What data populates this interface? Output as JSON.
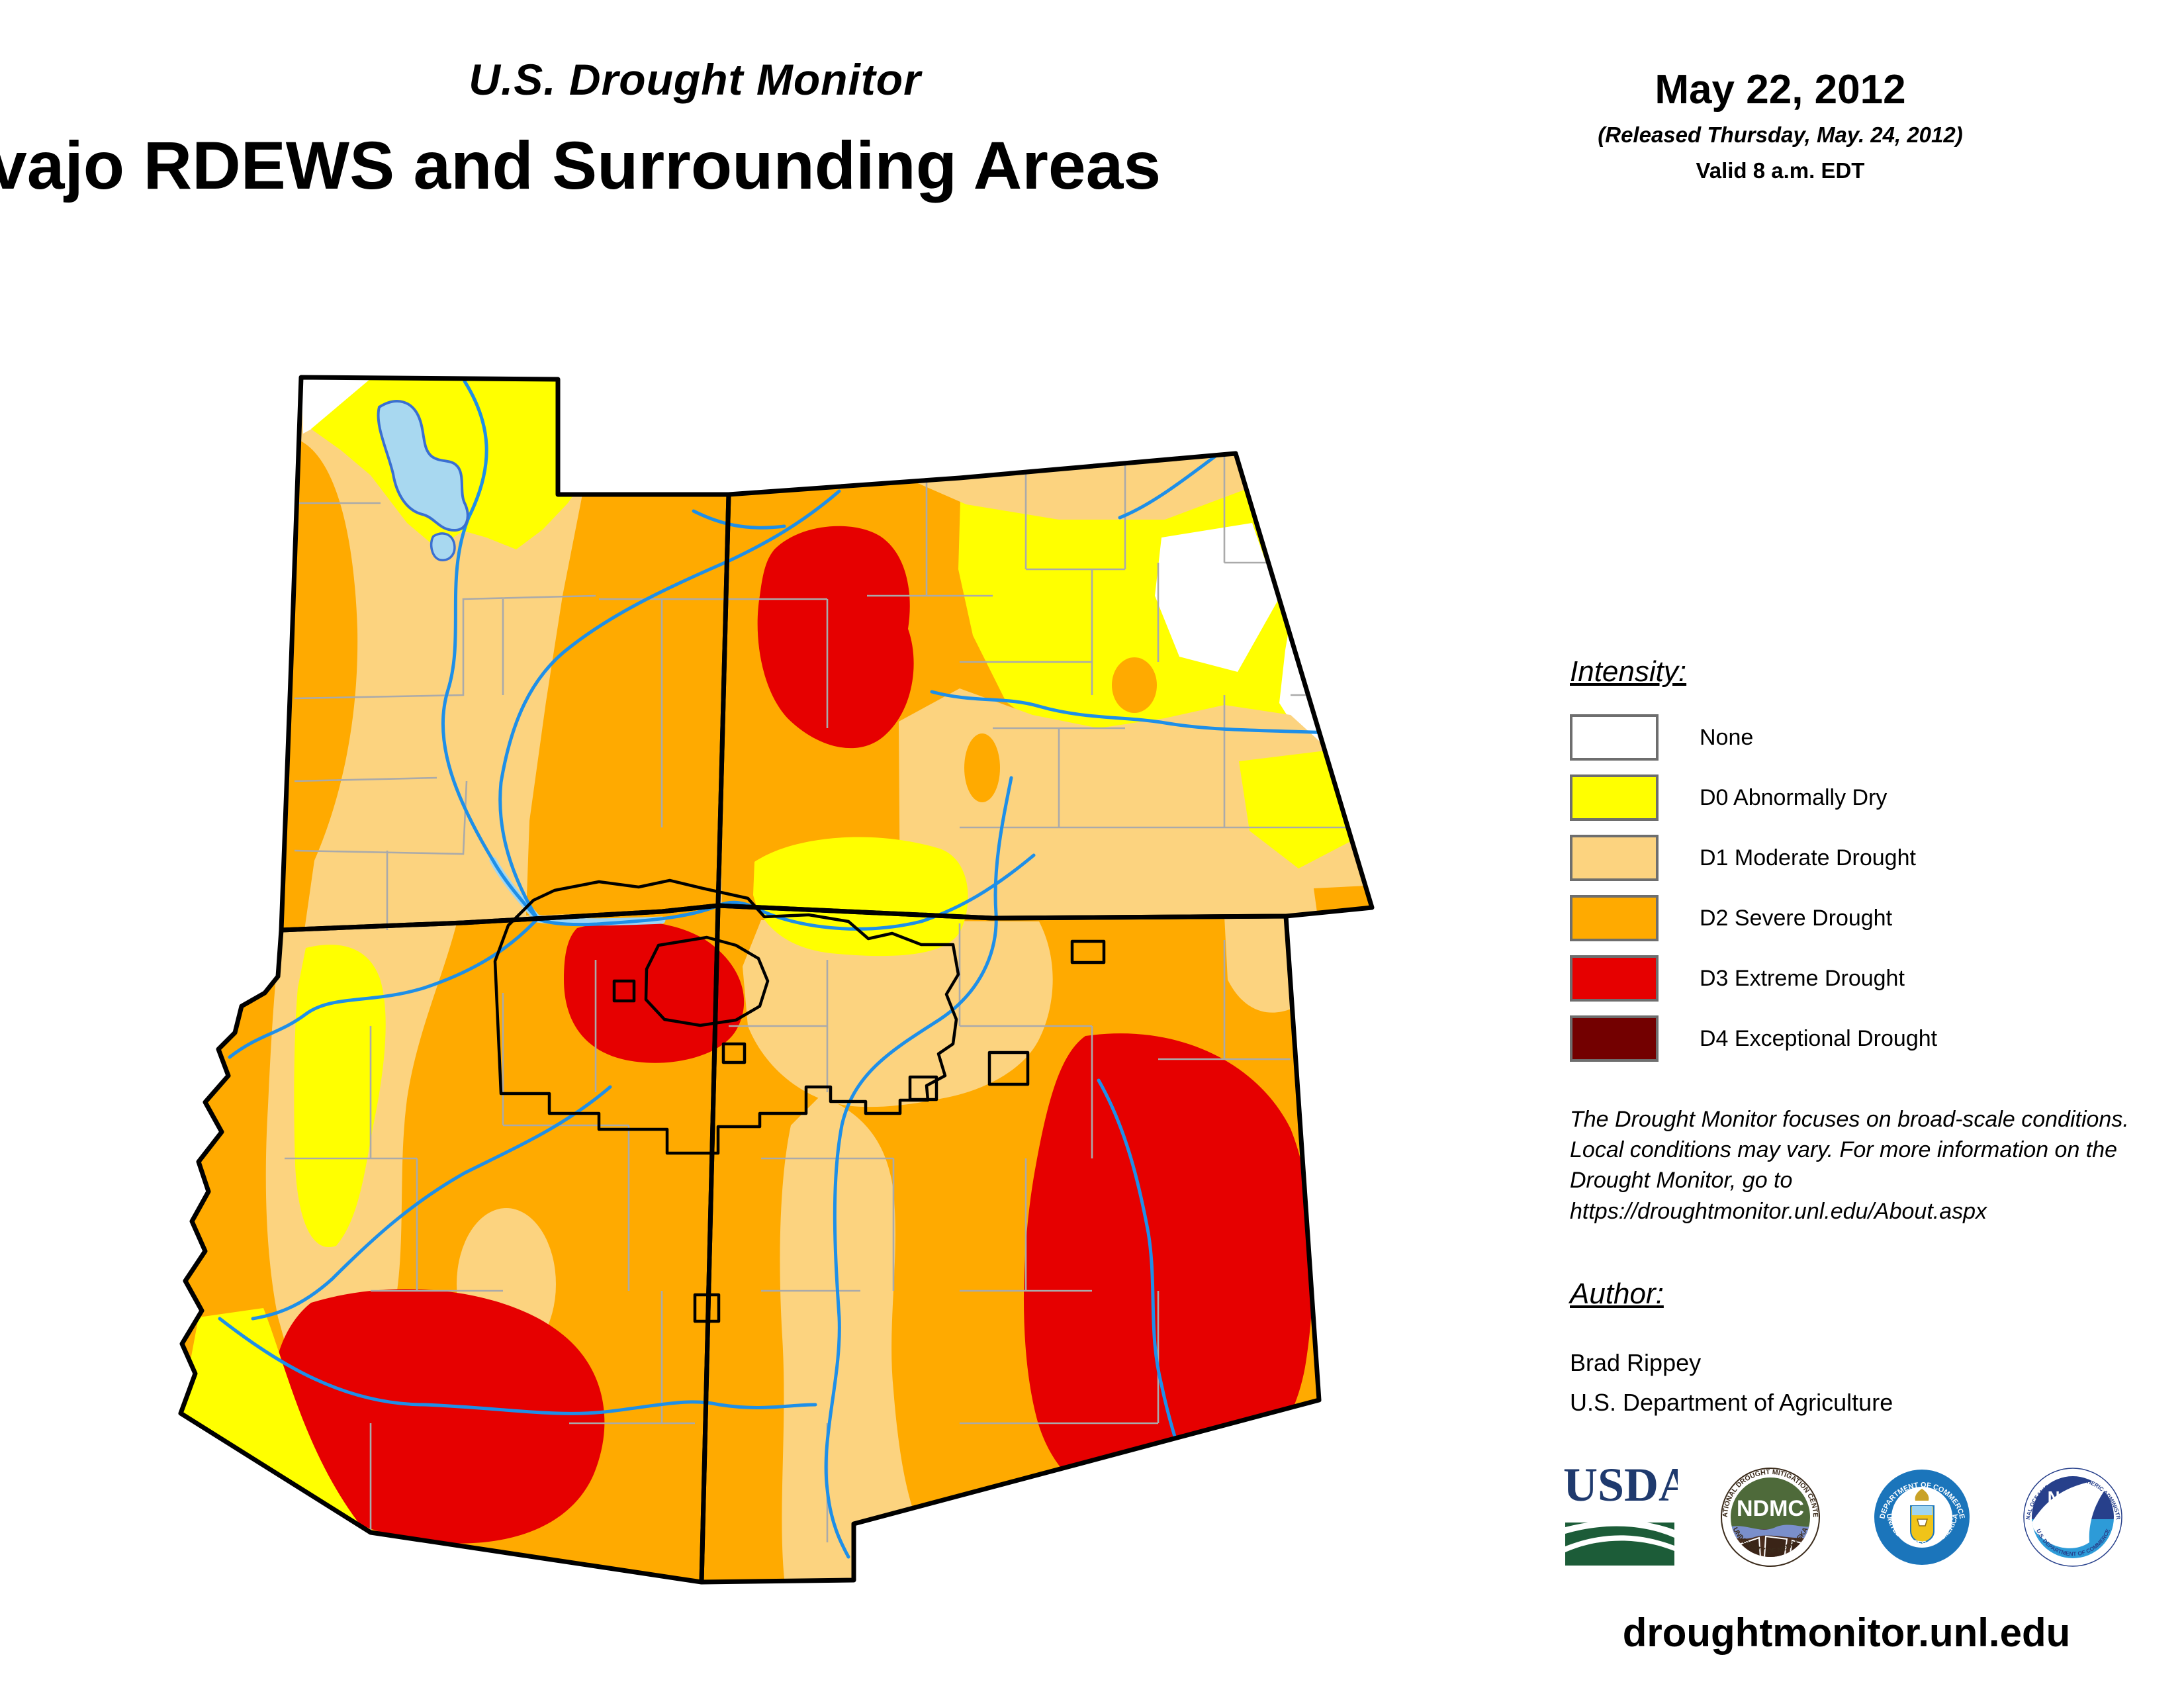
{
  "header": {
    "monitor_title": "U.S. Drought Monitor",
    "region_title": "vajo RDEWS and Surrounding Areas",
    "date": "May 22, 2012",
    "released": "(Released Thursday, May. 24, 2012)",
    "valid": "Valid 8 a.m. EDT"
  },
  "legend": {
    "heading": "Intensity:",
    "items": [
      {
        "label": "None",
        "color": "#FFFFFF"
      },
      {
        "label": "D0 Abnormally Dry",
        "color": "#FFFF00"
      },
      {
        "label": "D1 Moderate Drought",
        "color": "#FCD37F"
      },
      {
        "label": "D2 Severe Drought",
        "color": "#FFAA00"
      },
      {
        "label": "D3 Extreme Drought",
        "color": "#E60000"
      },
      {
        "label": "D4 Exceptional Drought",
        "color": "#730000"
      }
    ]
  },
  "disclaimer": "The Drought Monitor focuses on broad-scale conditions. Local conditions may vary. For more information on the Drought Monitor, go to https://droughtmonitor.unl.edu/About.aspx",
  "author": {
    "heading": "Author:",
    "name": "Brad Rippey",
    "org": "U.S. Department of Agriculture"
  },
  "footer": {
    "url": "droughtmonitor.unl.edu"
  },
  "logos": {
    "usda": {
      "text": "USDA"
    },
    "ndmc": {
      "text": "NDMC",
      "ring_top": "NATIONAL DROUGHT MITIGATION CENTER",
      "ring_bottom": "UNIVERSITY OF NEBRASKA"
    },
    "doc": {
      "ring_top": "DEPARTMENT OF COMMERCE",
      "ring_bottom": "UNITED STATES OF AMERICA"
    },
    "noaa": {
      "text": "NOAA",
      "ring_top": "NATIONAL OCEANIC AND ATMOSPHERIC ADMINISTRATION",
      "ring_bottom": "U.S. DEPARTMENT OF COMMERCE"
    }
  },
  "map": {
    "states_shown": [
      "Utah",
      "Colorado",
      "Arizona",
      "New Mexico"
    ],
    "overlay_outline": "Navajo Nation and surrounding tribal lands",
    "palette": {
      "none": "#FFFFFF",
      "d0": "#FFFF00",
      "d1": "#FCD37F",
      "d2": "#FFAA00",
      "d3": "#E60000",
      "d4": "#730000",
      "river": "#1E8FE8",
      "lake_fill": "#A8D8F0",
      "lake_edge": "#3B6FD1",
      "county_line": "#AAAAAA",
      "state_border": "#000000"
    }
  }
}
